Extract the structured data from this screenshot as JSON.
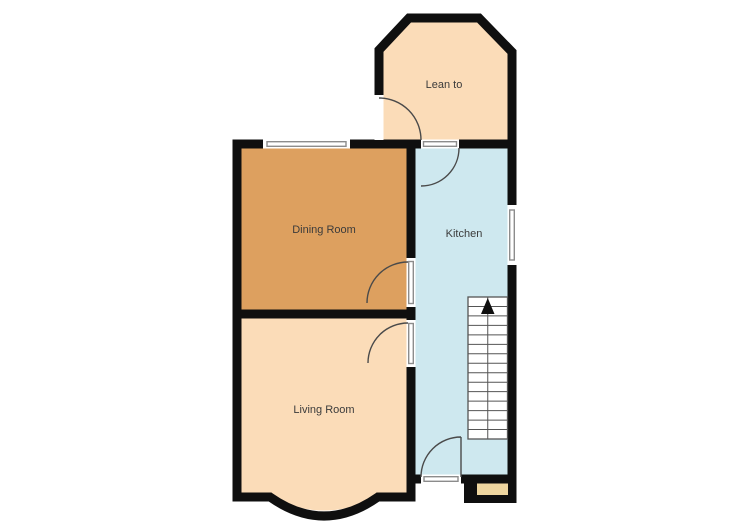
{
  "rooms": [
    {
      "id": "lean-to",
      "label": "Lean to"
    },
    {
      "id": "dining-room",
      "label": "Dining Room"
    },
    {
      "id": "kitchen",
      "label": "Kitchen"
    },
    {
      "id": "living-room",
      "label": "Living Room"
    }
  ],
  "stairs": {
    "treads": 14,
    "direction": "up",
    "arrow_icon": "up-arrow-icon"
  },
  "features": {
    "doors": [
      "lean-to-exterior-door",
      "kitchen-to-lean-to-door",
      "dining-to-kitchen-door",
      "living-to-kitchen-door",
      "kitchen-exterior-door"
    ],
    "windows": [
      "dining-room-front-window",
      "kitchen-side-window"
    ],
    "bay": "living-room-bow-window",
    "step": "kitchen-entry-step"
  },
  "colors": {
    "background": "#FFFFFF",
    "wall": "#0F0F0F",
    "peach": "#FBDCB8",
    "dining": "#DDA05F",
    "kitchen": "#CEE8EF",
    "step": "#EFD6A0",
    "window_frame": "#8C8C8C",
    "door_arc": "#4A4A4A",
    "stair_line": "#555555",
    "label_text": "#3B3B3B"
  }
}
